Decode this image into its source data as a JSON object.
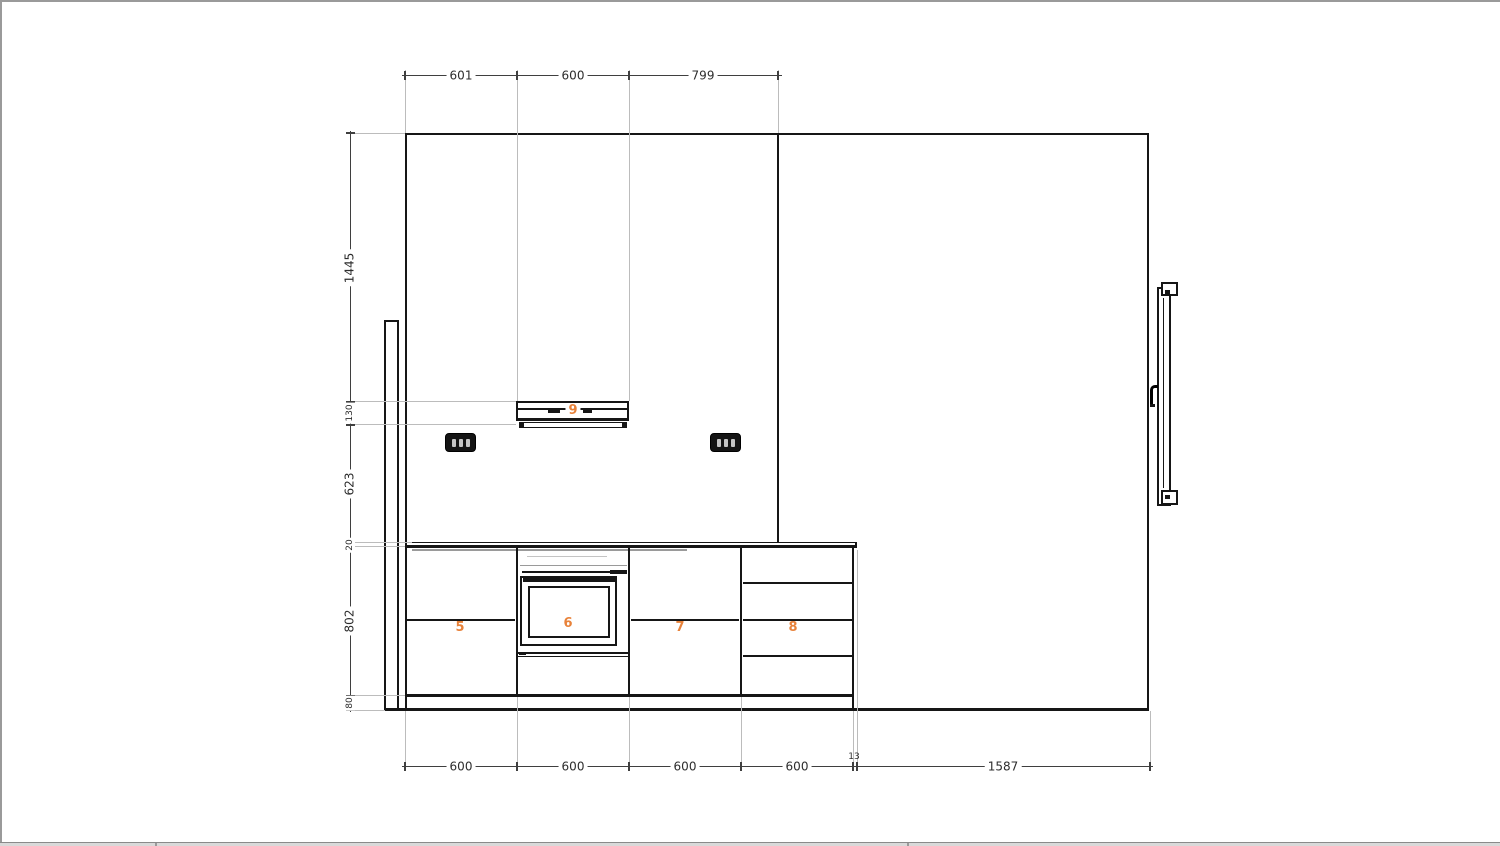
{
  "drawing": {
    "type": "kitchen-elevation-cad-view",
    "colors": {
      "line": "#161616",
      "dimension_line": "#3f3f3f",
      "dimension_text": "#2d2d2d",
      "extension_line": "#bcbcbc",
      "accent_orange": "#e8823a",
      "page_border": "#9a9a9a"
    },
    "dimensions": {
      "top": [
        "601",
        "600",
        "799"
      ],
      "left": [
        "1445",
        "130",
        "623",
        "20",
        "802",
        "80"
      ],
      "bottom": [
        "600",
        "600",
        "600",
        "600",
        "13",
        "1587"
      ]
    },
    "unit_labels": {
      "base_unit_1": "5",
      "oven_unit": "6",
      "base_unit_2": "7",
      "drawer_unit": "8",
      "hood_unit": "9"
    }
  }
}
